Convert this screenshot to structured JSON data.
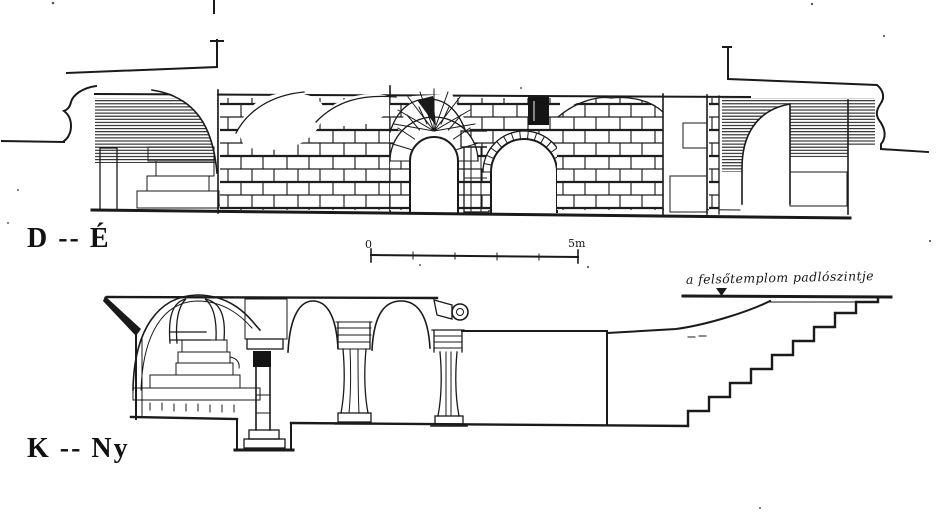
{
  "canvas": {
    "paper_color": "#ffffff",
    "ink_color": "#1a1a1a"
  },
  "sections": {
    "d_e": {
      "label": "D -- É"
    },
    "k_ny": {
      "label": "K -- Ny"
    }
  },
  "scale_bar": {
    "zero_label": "0",
    "end_label": "5m"
  },
  "annotations": {
    "floor_level": "a felsőtemplom padlószintje"
  }
}
